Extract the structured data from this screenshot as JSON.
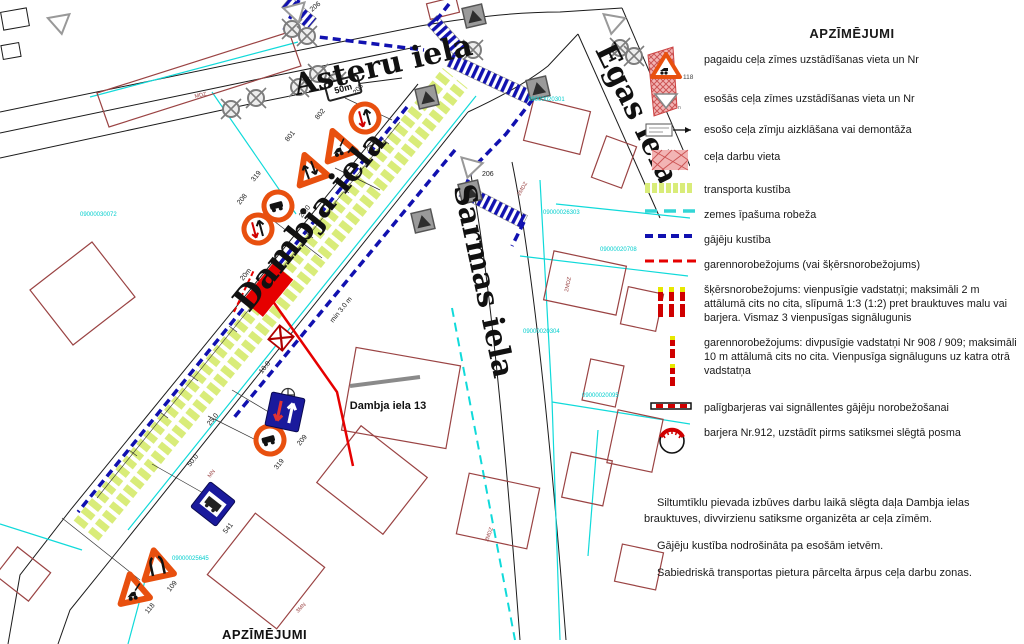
{
  "page": {
    "bottom_legend_title": "APZĪMĒJUMI"
  },
  "legend": {
    "title": "APZĪMĒJUMI",
    "items": [
      {
        "nr": "118",
        "text": "pagaidu ceļa zīmes uzstādīšanas vieta un Nr"
      },
      {
        "text": "esošās ceļa zīmes uzstādīšanas vieta un Nr"
      },
      {
        "text": "esošo ceļa zīmju aizklāšana vai demontāža"
      },
      {
        "text": "ceļa darbu vieta"
      },
      {
        "text": "transporta kustība"
      },
      {
        "text": "zemes īpašuma robeža"
      },
      {
        "text": "gājēju kustība"
      },
      {
        "text": "garennorobežojums (vai šķērsnorobežojums)"
      },
      {
        "text": "šķērsnorobežojums: vienpusīgie vadstatņi; maksimāli 2 m attālumā cits no cita, slīpumā 1:3 (1:2) pret brauktuves malu vai barjera. Vismaz 3 vienpusīgas signālugunis"
      },
      {
        "text": "garennorobežojums: divpusīgie vadstatņi Nr 908 / 909; maksimāli 10 m attālumā cits no cita. Vienpusīga signāluguns uz katra otrā vadstatņa"
      },
      {
        "text": "palīgbarjeras vai signāllentes gājēju norobežošanai"
      },
      {
        "text": "barjera Nr.912, uzstādīt pirms satiksmei slēgtā posma"
      }
    ]
  },
  "notes": {
    "p1": "Siltumtīklu pievada izbūves darbu laikā slēgta daļa Dambja ielas brauktuves, divvirzienu satiksme organizēta ar ceļa zīmēm.",
    "p2": "Gājēju kustība nodrošināta pa esošām ietvēm.",
    "p3": "Sabiedriskā transportas pietura pārcelta ārpus ceļa darbu zonas."
  },
  "map": {
    "streets": [
      {
        "name": "Asteru  iela"
      },
      {
        "name": "Dambja iela"
      },
      {
        "name": "Egas iela"
      },
      {
        "name": "Sarmas iela"
      }
    ],
    "address_label": "Dambja iela 13",
    "plate_50m": "50m",
    "cadastral": [
      "09000030072",
      "09000020301",
      "09000026303",
      "09000020708",
      "09000020304",
      "09000020095",
      "09000025645"
    ],
    "measurements": [
      "25.0",
      "25.0",
      "20m",
      "min 3.0 m",
      "10.0",
      "25.0",
      "50.0"
    ],
    "sign_labels": [
      "206",
      "208",
      "802",
      "801",
      "319",
      "208",
      "206",
      "209",
      "319",
      "541",
      "109",
      "118"
    ],
    "building_labels": [
      "MDZ",
      "2MDZ",
      "2MDZ",
      "MN",
      "3MN",
      "2MDZ"
    ],
    "colors": {
      "work_red": "#e60000",
      "sign_orange": "#e8500f",
      "pedestrian_blue": "#1111b0",
      "boundary_cyan": "#00d2d2",
      "transport_green": "#d9ec79",
      "building_maroon": "#9a4343",
      "sign_blue": "#1a1a9c"
    }
  }
}
